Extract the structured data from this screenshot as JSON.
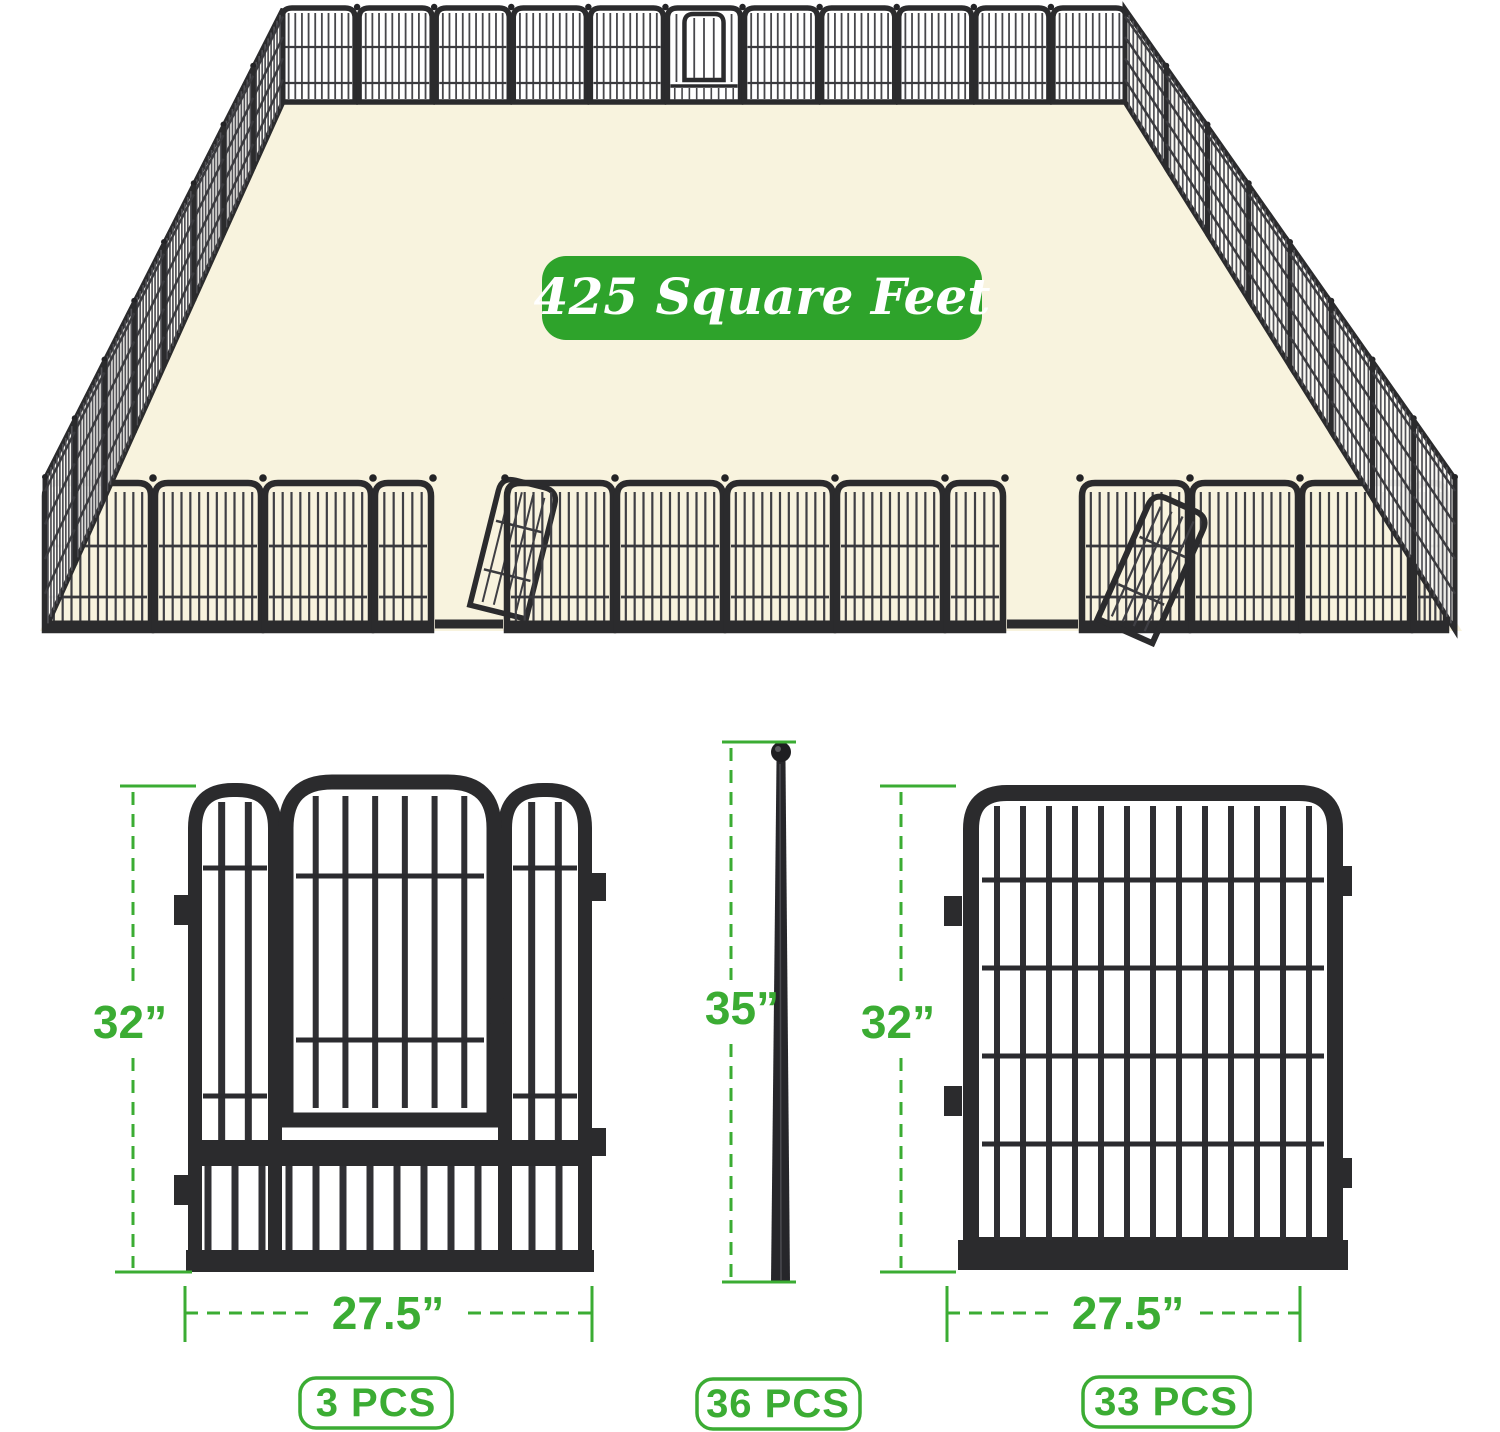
{
  "banner": {
    "label": "425 Square Feet"
  },
  "figures": {
    "door_panel": {
      "height_label": "32”",
      "width_label": "27.5”",
      "count_label": "3 PCS"
    },
    "ground_stake": {
      "height_label": "35”",
      "count_label": "36 PCS"
    },
    "regular_panel": {
      "height_label": "32”",
      "width_label": "27.5”",
      "count_label": "33 PCS"
    }
  },
  "colors": {
    "accent_green": "#3BAC33",
    "banner_green": "#2EA32B",
    "metal_dark": "#2B2B2D",
    "floor_cream": "#F8F3DE"
  }
}
